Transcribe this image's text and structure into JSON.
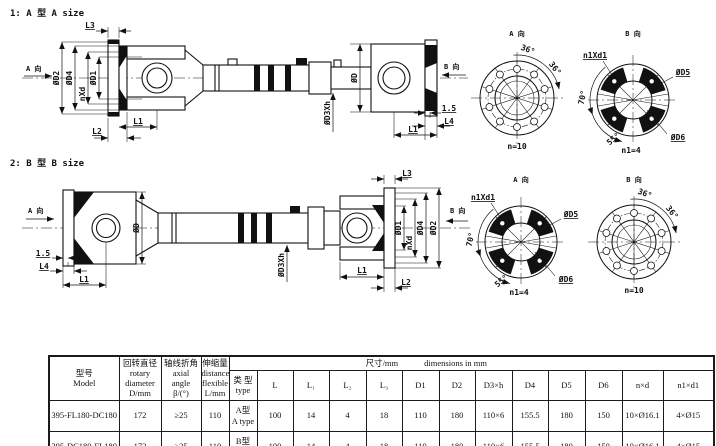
{
  "sections": {
    "s1_title": "1: A 型 A size",
    "s2_title": "2: B 型 B size"
  },
  "dims": {
    "view_a": "A 向",
    "view_b": "B 向",
    "L1": "L1",
    "L2": "L2",
    "L3": "L3",
    "L4": "L4",
    "d": "ØD",
    "d1": "ØD1",
    "d2": "ØD2",
    "d3h": "ØD3Xh",
    "d4": "ØD4",
    "nxd": "nXd",
    "dim15": "1.5",
    "n10": "n=10",
    "n1eq4": "n1=4",
    "n1xd1": "n1Xd1",
    "d5": "ØD5",
    "d6": "ØD6",
    "deg36": "36°",
    "deg70": "70°",
    "deg55": "55°"
  },
  "table": {
    "header": {
      "model_cn": "型号",
      "model_en": "Model",
      "rotary_cn": "回转直径",
      "rotary_en1": "rotary",
      "rotary_en2": "diameter",
      "rotary_unit": "D/mm",
      "angle_cn": "轴线折角",
      "angle_en1": "axial",
      "angle_en2": "angle",
      "angle_unit": "β/(°)",
      "flex_cn": "伸缩量",
      "flex_en1": "distance",
      "flex_en2": "flexible",
      "flex_unit": "L/mm",
      "dims_cn": "尺寸/mm",
      "dims_en": "dimensions in mm",
      "type_cn": "类 型",
      "type_en": "type",
      "cols": [
        "L",
        "L₁",
        "L₂",
        "L₃",
        "D1",
        "D2",
        "D3×h",
        "D4",
        "D5",
        "D6",
        "n×d",
        "n1×d1"
      ]
    },
    "rows": [
      {
        "model": "395-FL180-DC180",
        "rotary": "172",
        "angle": "≥25",
        "flex": "110",
        "type_cn": "A型",
        "type_en": "A type",
        "vals": [
          "100",
          "14",
          "4",
          "18",
          "110",
          "180",
          "110×6",
          "155.5",
          "180",
          "150",
          "10×Ø16.1",
          "4×Ø15"
        ]
      },
      {
        "model": "395-DC180-FL180",
        "rotary": "172",
        "angle": "≥25",
        "flex": "110",
        "type_cn": "B型",
        "type_en": "B type",
        "vals": [
          "100",
          "14",
          "4",
          "18",
          "110",
          "180",
          "110×6",
          "155.5",
          "180",
          "150",
          "10×Ø16.1",
          "4×Ø15"
        ]
      }
    ]
  }
}
